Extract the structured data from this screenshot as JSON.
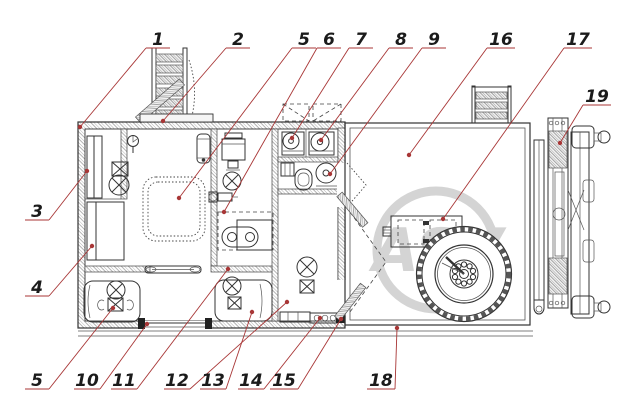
{
  "drawing": {
    "watermark": "ASV",
    "kind": "trailer-cabin-floor-plan"
  },
  "colors": {
    "leader": "#a83636",
    "ink": "#333333",
    "watermark": "#cdcdcd"
  },
  "callouts": [
    {
      "text": "1",
      "x1": 146,
      "x2": 170,
      "y": 48,
      "tx": 80,
      "ty": 127
    },
    {
      "text": "2",
      "x1": 226,
      "x2": 250,
      "y": 48,
      "tx": 163,
      "ty": 121
    },
    {
      "text": "5",
      "x1": 292,
      "x2": 316,
      "y": 48,
      "tx": 179,
      "ty": 198
    },
    {
      "text": "6",
      "x1": 317,
      "x2": 341,
      "y": 48,
      "tx": 224,
      "ty": 212
    },
    {
      "text": "7",
      "x1": 349,
      "x2": 373,
      "y": 48,
      "tx": 292,
      "ty": 138
    },
    {
      "text": "8",
      "x1": 389,
      "x2": 413,
      "y": 48,
      "tx": 321,
      "ty": 140
    },
    {
      "text": "9",
      "x1": 422,
      "x2": 446,
      "y": 48,
      "tx": 330,
      "ty": 174
    },
    {
      "text": "16",
      "x1": 487,
      "x2": 515,
      "y": 48,
      "tx": 409,
      "ty": 155
    },
    {
      "text": "17",
      "x1": 564,
      "x2": 592,
      "y": 48,
      "tx": 443,
      "ty": 219
    },
    {
      "text": "19",
      "x1": 583,
      "x2": 611,
      "y": 105,
      "tx": 560,
      "ty": 143
    },
    {
      "text": "3",
      "x1": 25,
      "x2": 49,
      "y": 220,
      "tx": 87,
      "ty": 171
    },
    {
      "text": "4",
      "x1": 25,
      "x2": 49,
      "y": 296,
      "tx": 92,
      "ty": 246
    },
    {
      "text": "5",
      "x1": 25,
      "x2": 49,
      "y": 389,
      "tx": 113,
      "ty": 308
    },
    {
      "text": "10",
      "x1": 74,
      "x2": 100,
      "y": 389,
      "tx": 147,
      "ty": 324
    },
    {
      "text": "11",
      "x1": 111,
      "x2": 137,
      "y": 389,
      "tx": 228,
      "ty": 269
    },
    {
      "text": "12",
      "x1": 164,
      "x2": 190,
      "y": 389,
      "tx": 287,
      "ty": 302
    },
    {
      "text": "13",
      "x1": 200,
      "x2": 226,
      "y": 389,
      "tx": 252,
      "ty": 312
    },
    {
      "text": "14",
      "x1": 238,
      "x2": 264,
      "y": 389,
      "tx": 320,
      "ty": 318
    },
    {
      "text": "15",
      "x1": 270,
      "x2": 298,
      "y": 389,
      "tx": 341,
      "ty": 319
    },
    {
      "text": "18",
      "x1": 367,
      "x2": 395,
      "y": 389,
      "tx": 397,
      "ty": 328
    }
  ]
}
